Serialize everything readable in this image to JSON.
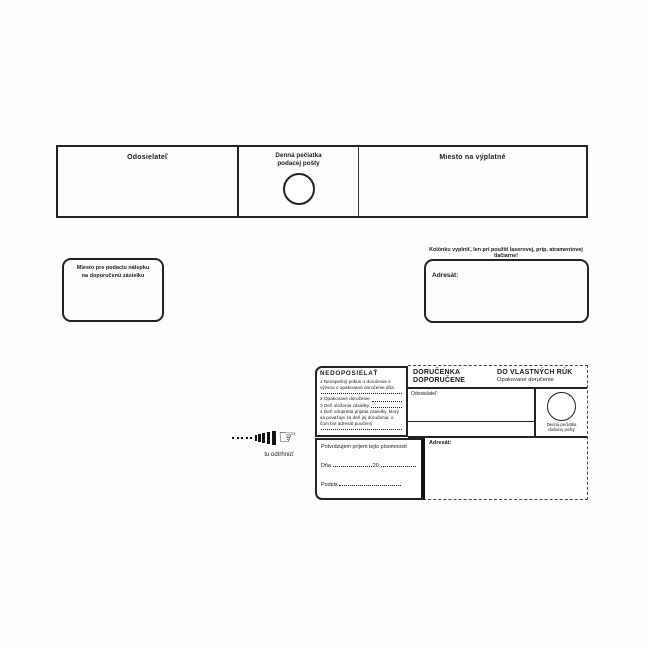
{
  "top_strip": {
    "sender_label": "Odosielateľ",
    "stamp_label_line1": "Denná pečiatka",
    "stamp_label_line2": "podacej pošty",
    "postage_label": "Miesto na výplatné"
  },
  "sticker_box": {
    "line1": "Miesto pre podaciu nálepku",
    "line2": "na doporučenú zásielku"
  },
  "addressee_box": {
    "printer_note": "Kolónku vyplniť, len pri použití laserovej, príp. atramentovej tlačiarne!",
    "label": "Adresát:"
  },
  "tear_off": {
    "hand_glyph": "☞",
    "label": "tu odtrhnúť"
  },
  "delivery_card": {
    "nedoposielat": {
      "title": "NEDOPOSIELAŤ",
      "item1": "1 Neúspešný pokus o doručenie s výzvou o opakované doručenie dňa",
      "item2": "2 Opakované doručenie",
      "item3": "3 Deň uloženia zásielky",
      "item4": "4 Deň odopretia prijatia zásielky, ktorý sa považuje za deň jej doručenia, o čom bol adresát poučený"
    },
    "header": {
      "title1": "DORUČENKA",
      "title2": "DOPORUČENE",
      "title3": "DO VLASTNÝCH RÚK",
      "subtitle": "Opakované doručenie"
    },
    "sender_label": "Odosielateľ:",
    "stamp_caption_line1": "Denná pečiatka",
    "stamp_caption_line2": "dodacej pošty",
    "addressee_label": "Adresát:",
    "confirm": {
      "statement": "Potvrdzujem príjem tejto písomnosti",
      "date_label": "Dňa",
      "year_label": "20",
      "signature_label": "Podpis"
    }
  },
  "colors": {
    "ink": "#1b1b1b",
    "paper": "#fdfdfd"
  }
}
